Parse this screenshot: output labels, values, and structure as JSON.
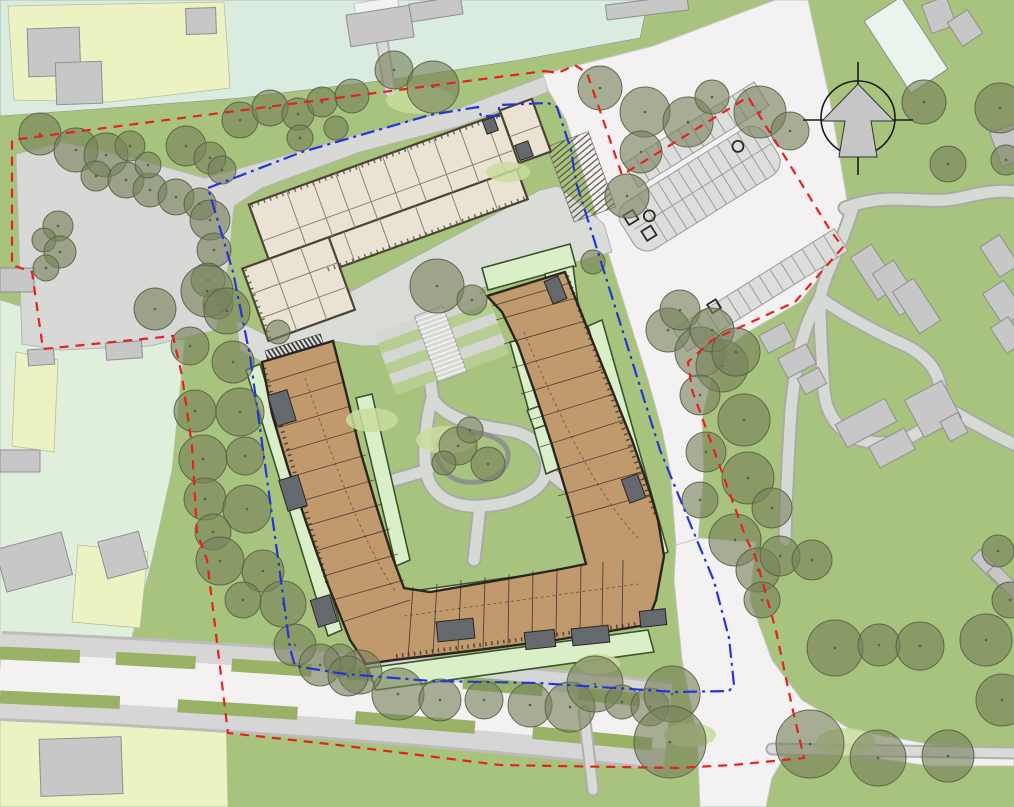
{
  "drawing": {
    "kind": "architectural site plan",
    "aria_label": "Site plan drawing with U-shaped residential building, school building, parking lot, tree belts, red dashed site boundary and blue dash-dot application boundary, north arrow top right"
  },
  "palette": {
    "lawn": "#a8c37d",
    "teal": "#d9ecdf",
    "parcel_yellow": "#edf2c2",
    "parcel_mint": "#e0efdc",
    "context_gray": "#c7c7c7",
    "context_outline": "#8f8f8f",
    "mint_building": "#e9f4ec",
    "road_white": "#f4f1f2",
    "walk_gray": "#d6d6d6",
    "plaza_gray": "#dadcd8",
    "nw_gray": "#d8d8d6",
    "verge_green": "#9ab266",
    "garden_pale": "#daefc8",
    "garden_border": "#3a5430",
    "beige_fill": "#eae3d3",
    "beige_wall": "#4a4434",
    "beige_line": "#8a8274",
    "brown_fill": "#c09a6c",
    "brown_wall": "#2b2521",
    "core_gray": "#65686d",
    "tree_fill": "#77815a",
    "tree_line": "#566044",
    "pond_line": "#8f9390",
    "terrace_green": "#b7ce92",
    "terrace_gray": "#d4d6d1",
    "stall_line": "#9b9d9a",
    "red": "#e3231c",
    "blue": "#2238d4"
  },
  "north_arrow": {
    "cx": 858,
    "cy": 118,
    "r": 37
  },
  "boundaries": {
    "red_dashed": {
      "label": "red dashed boundary",
      "points": [
        [
          545,
          71
        ],
        [
          558,
          73
        ],
        [
          575,
          65
        ],
        [
          587,
          73
        ],
        [
          622,
          175
        ],
        [
          748,
          97
        ],
        [
          793,
          170
        ],
        [
          830,
          230
        ],
        [
          843,
          247
        ],
        [
          795,
          302
        ],
        [
          712,
          340
        ],
        [
          688,
          362
        ],
        [
          692,
          390
        ],
        [
          746,
          538
        ],
        [
          756,
          558
        ],
        [
          776,
          631
        ],
        [
          793,
          711
        ],
        [
          804,
          758
        ],
        [
          733,
          765
        ],
        [
          676,
          768
        ],
        [
          500,
          765
        ],
        [
          338,
          745
        ],
        [
          228,
          733
        ],
        [
          207,
          560
        ],
        [
          197,
          532
        ],
        [
          192,
          446
        ],
        [
          182,
          376
        ],
        [
          173,
          336
        ],
        [
          43,
          349
        ],
        [
          32,
          272
        ],
        [
          12,
          265
        ],
        [
          12,
          140
        ],
        [
          545,
          71
        ]
      ]
    },
    "blue_dash_dot": {
      "label": "blue dash-dot boundary",
      "points": [
        [
          208,
          188
        ],
        [
          302,
          152
        ],
        [
          430,
          115
        ],
        [
          478,
          107
        ],
        [
          481,
          116
        ],
        [
          499,
          116
        ],
        [
          499,
          105
        ],
        [
          548,
          103
        ],
        [
          557,
          107
        ],
        [
          571,
          150
        ],
        [
          576,
          182
        ],
        [
          638,
          380
        ],
        [
          660,
          450
        ],
        [
          696,
          538
        ],
        [
          714,
          581
        ],
        [
          729,
          638
        ],
        [
          734,
          685
        ],
        [
          729,
          691
        ],
        [
          676,
          692
        ],
        [
          538,
          683
        ],
        [
          431,
          681
        ],
        [
          358,
          675
        ],
        [
          338,
          673
        ],
        [
          295,
          666
        ],
        [
          290,
          648
        ],
        [
          277,
          551
        ],
        [
          267,
          479
        ],
        [
          250,
          356
        ],
        [
          233,
          272
        ],
        [
          208,
          188
        ]
      ]
    }
  },
  "parking": {
    "rotation_deg": -32,
    "pivot": [
      642,
      257
    ],
    "island": {
      "x": 642,
      "y": 202,
      "w": 170,
      "h": 55,
      "stall_x0": 660,
      "stalls_per_row": 13
    },
    "nw_row": {
      "x": 676,
      "y": 168,
      "w": 154,
      "h": 28,
      "stalls": 12
    },
    "se_row": {
      "x": 630,
      "y": 335,
      "w": 190,
      "h": 26,
      "stalls": 15
    }
  },
  "trees": [
    [
      40,
      134,
      21
    ],
    [
      76,
      150,
      22
    ],
    [
      106,
      155,
      22
    ],
    [
      130,
      146,
      15
    ],
    [
      96,
      176,
      15
    ],
    [
      126,
      180,
      18
    ],
    [
      150,
      190,
      17
    ],
    [
      176,
      197,
      18
    ],
    [
      200,
      204,
      16
    ],
    [
      148,
      165,
      13
    ],
    [
      186,
      146,
      20
    ],
    [
      210,
      158,
      16
    ],
    [
      222,
      170,
      14
    ],
    [
      58,
      226,
      15
    ],
    [
      44,
      240,
      12
    ],
    [
      60,
      252,
      16
    ],
    [
      46,
      268,
      13
    ],
    [
      210,
      220,
      20
    ],
    [
      214,
      250,
      17
    ],
    [
      208,
      280,
      17
    ],
    [
      218,
      304,
      15
    ],
    [
      240,
      120,
      18
    ],
    [
      270,
      108,
      18
    ],
    [
      298,
      114,
      16
    ],
    [
      322,
      102,
      15
    ],
    [
      352,
      96,
      17
    ],
    [
      394,
      70,
      19
    ],
    [
      433,
      87,
      26
    ],
    [
      300,
      138,
      13
    ],
    [
      336,
      128,
      12
    ],
    [
      600,
      88,
      22
    ],
    [
      645,
      112,
      25
    ],
    [
      688,
      122,
      25
    ],
    [
      712,
      97,
      17
    ],
    [
      760,
      112,
      26
    ],
    [
      790,
      131,
      19
    ],
    [
      924,
      102,
      22
    ],
    [
      1000,
      108,
      25
    ],
    [
      948,
      164,
      18
    ],
    [
      1006,
      160,
      15
    ],
    [
      641,
      152,
      21
    ],
    [
      627,
      196,
      22
    ],
    [
      668,
      330,
      22
    ],
    [
      700,
      352,
      25
    ],
    [
      722,
      366,
      26
    ],
    [
      680,
      310,
      20
    ],
    [
      712,
      330,
      22
    ],
    [
      736,
      352,
      24
    ],
    [
      700,
      395,
      20
    ],
    [
      744,
      420,
      26
    ],
    [
      706,
      452,
      20
    ],
    [
      748,
      478,
      26
    ],
    [
      700,
      500,
      18
    ],
    [
      772,
      508,
      20
    ],
    [
      735,
      540,
      26
    ],
    [
      758,
      570,
      22
    ],
    [
      780,
      556,
      20
    ],
    [
      762,
      600,
      18
    ],
    [
      812,
      560,
      20
    ],
    [
      835,
      648,
      28
    ],
    [
      879,
      645,
      21
    ],
    [
      920,
      646,
      24
    ],
    [
      810,
      744,
      34
    ],
    [
      878,
      758,
      28
    ],
    [
      948,
      756,
      26
    ],
    [
      1002,
      700,
      26
    ],
    [
      986,
      640,
      26
    ],
    [
      1010,
      600,
      18
    ],
    [
      998,
      551,
      16
    ],
    [
      398,
      694,
      26
    ],
    [
      440,
      700,
      21
    ],
    [
      484,
      700,
      19
    ],
    [
      530,
      705,
      22
    ],
    [
      570,
      707,
      25
    ],
    [
      595,
      684,
      28
    ],
    [
      622,
      702,
      17
    ],
    [
      650,
      707,
      19
    ],
    [
      672,
      694,
      28
    ],
    [
      670,
      742,
      36
    ],
    [
      360,
      672,
      22
    ],
    [
      340,
      660,
      16
    ],
    [
      155,
      309,
      21
    ],
    [
      207,
      291,
      26
    ],
    [
      227,
      311,
      23
    ],
    [
      190,
      346,
      19
    ],
    [
      233,
      362,
      21
    ],
    [
      195,
      411,
      21
    ],
    [
      240,
      412,
      24
    ],
    [
      203,
      459,
      24
    ],
    [
      245,
      456,
      19
    ],
    [
      205,
      499,
      21
    ],
    [
      247,
      509,
      24
    ],
    [
      213,
      532,
      18
    ],
    [
      220,
      561,
      24
    ],
    [
      263,
      571,
      21
    ],
    [
      283,
      604,
      23
    ],
    [
      243,
      600,
      18
    ],
    [
      295,
      645,
      21
    ],
    [
      320,
      665,
      21
    ],
    [
      348,
      676,
      20
    ],
    [
      437,
      286,
      27
    ],
    [
      472,
      300,
      15
    ],
    [
      458,
      446,
      19
    ],
    [
      488,
      464,
      17
    ],
    [
      444,
      463,
      12
    ],
    [
      470,
      430,
      13
    ],
    [
      278,
      332,
      12
    ],
    [
      593,
      262,
      12
    ]
  ],
  "understory": [
    [
      420,
      100,
      34,
      14
    ],
    [
      508,
      172,
      22,
      10
    ],
    [
      372,
      420,
      26,
      12
    ],
    [
      446,
      440,
      30,
      14
    ],
    [
      846,
      742,
      30,
      14
    ],
    [
      690,
      735,
      26,
      12
    ],
    [
      598,
      664,
      22,
      10
    ]
  ],
  "context_buildings": [
    {
      "x": 348,
      "y": 10,
      "w": 64,
      "h": 32,
      "rot": -9,
      "f": "gray"
    },
    {
      "x": 410,
      "y": 0,
      "w": 52,
      "h": 18,
      "rot": -9,
      "f": "gray"
    },
    {
      "x": 606,
      "y": 0,
      "w": 82,
      "h": 15,
      "rot": -7,
      "f": "gray"
    },
    {
      "x": 884,
      "y": 2,
      "w": 44,
      "h": 86,
      "rot": -33,
      "f": "mint"
    },
    {
      "x": 926,
      "y": 0,
      "w": 26,
      "h": 30,
      "rot": -20,
      "f": "gray"
    },
    {
      "x": 953,
      "y": 14,
      "w": 24,
      "h": 28,
      "rot": -33,
      "f": "gray"
    },
    {
      "x": 995,
      "y": 127,
      "w": 28,
      "h": 36,
      "rot": -20,
      "f": "gray"
    },
    {
      "x": 28,
      "y": 28,
      "w": 52,
      "h": 48,
      "rot": -2,
      "f": "gray"
    },
    {
      "x": 56,
      "y": 62,
      "w": 46,
      "h": 42,
      "rot": -2,
      "f": "gray"
    },
    {
      "x": 186,
      "y": 8,
      "w": 30,
      "h": 26,
      "rot": -2,
      "f": "gray"
    },
    {
      "x": 0,
      "y": 268,
      "w": 34,
      "h": 24,
      "rot": 0,
      "f": "gray"
    },
    {
      "x": 28,
      "y": 349,
      "w": 26,
      "h": 16,
      "rot": -4,
      "f": "gray"
    },
    {
      "x": 106,
      "y": 342,
      "w": 36,
      "h": 17,
      "rot": -4,
      "f": "gray"
    },
    {
      "x": 0,
      "y": 450,
      "w": 40,
      "h": 22,
      "rot": 0,
      "f": "gray"
    },
    {
      "x": 0,
      "y": 540,
      "w": 68,
      "h": 44,
      "rot": -15,
      "f": "gray"
    },
    {
      "x": 102,
      "y": 536,
      "w": 42,
      "h": 38,
      "rot": -15,
      "f": "gray"
    },
    {
      "x": 40,
      "y": 738,
      "w": 82,
      "h": 57,
      "rot": -2,
      "f": "gray"
    },
    {
      "x": 862,
      "y": 247,
      "w": 25,
      "h": 50,
      "rot": -33,
      "f": "gray"
    },
    {
      "x": 884,
      "y": 263,
      "w": 25,
      "h": 50,
      "rot": -33,
      "f": "gray"
    },
    {
      "x": 904,
      "y": 281,
      "w": 25,
      "h": 50,
      "rot": -33,
      "f": "gray"
    },
    {
      "x": 988,
      "y": 238,
      "w": 23,
      "h": 36,
      "rot": -33,
      "f": "gray"
    },
    {
      "x": 991,
      "y": 284,
      "w": 25,
      "h": 38,
      "rot": -33,
      "f": "gray"
    },
    {
      "x": 997,
      "y": 320,
      "w": 21,
      "h": 30,
      "rot": -33,
      "f": "gray"
    },
    {
      "x": 838,
      "y": 410,
      "w": 56,
      "h": 26,
      "rot": -28,
      "f": "gray"
    },
    {
      "x": 872,
      "y": 436,
      "w": 40,
      "h": 24,
      "rot": -28,
      "f": "gray"
    },
    {
      "x": 912,
      "y": 388,
      "w": 42,
      "h": 42,
      "rot": -28,
      "f": "gray"
    },
    {
      "x": 944,
      "y": 416,
      "w": 20,
      "h": 22,
      "rot": -28,
      "f": "gray"
    },
    {
      "x": 762,
      "y": 328,
      "w": 28,
      "h": 20,
      "rot": -28,
      "f": "gray"
    },
    {
      "x": 781,
      "y": 350,
      "w": 32,
      "h": 22,
      "rot": -28,
      "f": "gray"
    },
    {
      "x": 800,
      "y": 372,
      "w": 24,
      "h": 18,
      "rot": -28,
      "f": "gray"
    },
    {
      "x": 984,
      "y": 548,
      "w": 13,
      "h": 42,
      "rot": -45,
      "f": "gray"
    },
    {
      "x": 1000,
      "y": 562,
      "w": 13,
      "h": 42,
      "rot": -45,
      "f": "gray"
    }
  ],
  "building_cores": [
    {
      "x": 272,
      "y": 392,
      "w": 20,
      "h": 32,
      "rot": -17
    },
    {
      "x": 283,
      "y": 477,
      "w": 20,
      "h": 32,
      "rot": -17
    },
    {
      "x": 314,
      "y": 597,
      "w": 20,
      "h": 28,
      "rot": -17
    },
    {
      "x": 437,
      "y": 620,
      "w": 37,
      "h": 20,
      "rot": -6
    },
    {
      "x": 525,
      "y": 631,
      "w": 30,
      "h": 17,
      "rot": -6
    },
    {
      "x": 572,
      "y": 627,
      "w": 37,
      "h": 17,
      "rot": -6
    },
    {
      "x": 640,
      "y": 610,
      "w": 26,
      "h": 16,
      "rot": -6
    },
    {
      "x": 548,
      "y": 278,
      "w": 15,
      "h": 24,
      "rot": -22
    },
    {
      "x": 625,
      "y": 476,
      "w": 17,
      "h": 25,
      "rot": -20
    }
  ]
}
